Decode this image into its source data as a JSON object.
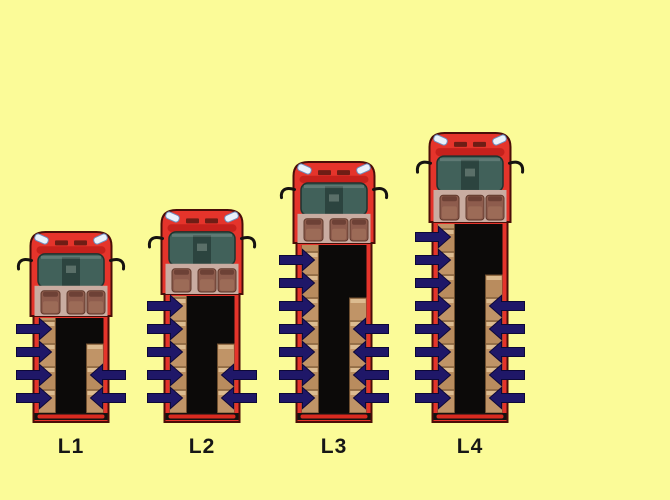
{
  "diagram": {
    "background_color": "#fbfb98",
    "label_color": "#161616",
    "bottom_y": 422,
    "label_top_y": 435,
    "style": {
      "bed_width": 75,
      "cab_width": 81,
      "body_red": "#e5342b",
      "body_red_dark": "#c6211c",
      "outline_dark": "#4a0d08",
      "bed_black": "#0c0a09",
      "box_tan": "#c09467",
      "box_tan_alt": "#b98c5e",
      "box_highlight": "#dcbb90",
      "box_border": "#6f4f2f",
      "windshield_teal": "#41615a",
      "windshield_dark": "#2c443f",
      "cabin_floor_pink": "#c9aca1",
      "seat_brown": "#8e5c4d",
      "seat_brown_dark": "#6d4136",
      "seat_cushion": "#9c6b57",
      "headlight_white": "#eaf1fb",
      "headlight_border": "#6d8fc0",
      "grille_dark": "#6f1d15",
      "mirror_black": "#151210",
      "bumper_red": "#d92a20"
    },
    "arrow": {
      "color": "#1f1768",
      "border": "#0d0838",
      "row_bottom_y": 398,
      "row_spacing": 23,
      "shaft_thickness": 9,
      "head_span": 21,
      "head_length": 12,
      "outside_reach": 17,
      "inside_reach": 18
    },
    "trucks": [
      {
        "label": "L1",
        "center_x": 71,
        "top_y": 232,
        "bed_top_y": 316,
        "left_arrows": 4,
        "right_arrows": 2,
        "right_boxes_top_y": 364
      },
      {
        "label": "L2",
        "center_x": 202,
        "top_y": 210,
        "bed_top_y": 294,
        "left_arrows": 5,
        "right_arrows": 2,
        "right_boxes_top_y": 364
      },
      {
        "label": "L3",
        "center_x": 334,
        "top_y": 162,
        "bed_top_y": 243,
        "left_arrows": 7,
        "right_arrows": 4,
        "right_boxes_top_y": 318
      },
      {
        "label": "L4",
        "center_x": 470,
        "top_y": 133,
        "bed_top_y": 222,
        "left_arrows": 8,
        "right_arrows": 5,
        "right_boxes_top_y": 295
      }
    ]
  }
}
